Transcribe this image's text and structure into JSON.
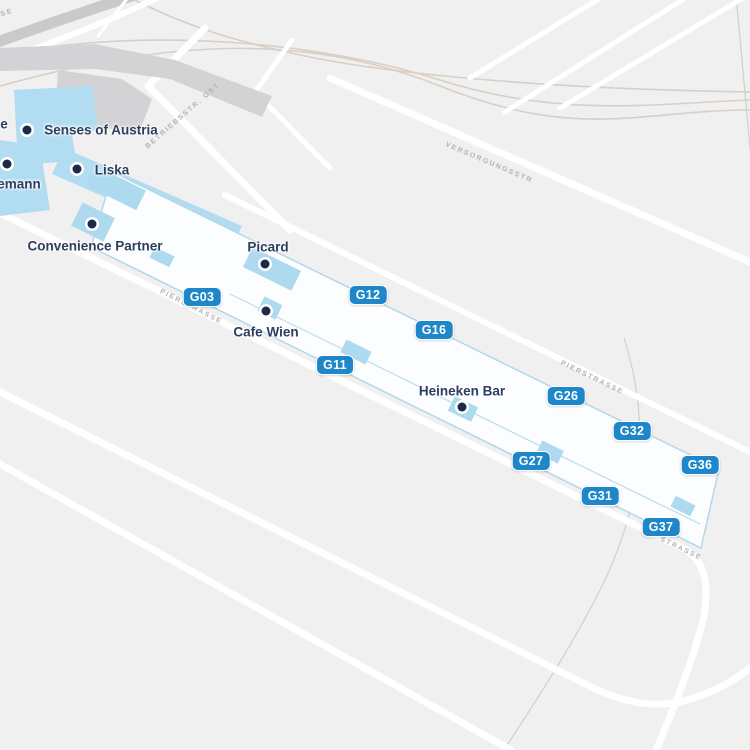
{
  "map": {
    "pois": [
      {
        "label": "Senses of Austria",
        "label_x": 101,
        "label_y": 130,
        "dot_x": 27,
        "dot_y": 130
      },
      {
        "label": "Liska",
        "label_x": 112,
        "label_y": 170,
        "dot_x": 77,
        "dot_y": 169
      },
      {
        "label": "emann",
        "label_x": 19,
        "label_y": 184,
        "dot_x": 7,
        "dot_y": 164
      },
      {
        "label": "Convenience Partner",
        "label_x": 95,
        "label_y": 246,
        "dot_x": 92,
        "dot_y": 224
      },
      {
        "label": "Picard",
        "label_x": 268,
        "label_y": 247,
        "dot_x": 265,
        "dot_y": 264
      },
      {
        "label": "Cafe Wien",
        "label_x": 266,
        "label_y": 332,
        "dot_x": 266,
        "dot_y": 311
      },
      {
        "label": "Heineken Bar",
        "label_x": 462,
        "label_y": 391,
        "dot_x": 462,
        "dot_y": 407
      }
    ],
    "partial_labels": [
      {
        "text": "e",
        "x": 4,
        "y": 124
      }
    ],
    "gates": [
      {
        "label": "G03",
        "x": 202,
        "y": 297
      },
      {
        "label": "G11",
        "x": 335,
        "y": 365
      },
      {
        "label": "G12",
        "x": 368,
        "y": 295
      },
      {
        "label": "G16",
        "x": 434,
        "y": 330
      },
      {
        "label": "G26",
        "x": 566,
        "y": 396
      },
      {
        "label": "G27",
        "x": 531,
        "y": 461
      },
      {
        "label": "G31",
        "x": 600,
        "y": 496
      },
      {
        "label": "G32",
        "x": 632,
        "y": 431
      },
      {
        "label": "G36",
        "x": 700,
        "y": 465
      },
      {
        "label": "G37",
        "x": 661,
        "y": 527
      }
    ],
    "streets": [
      {
        "text": "SE",
        "x": 7,
        "y": 13,
        "rot": -18
      },
      {
        "text": "BETRIEBSSTR. OST",
        "x": 183,
        "y": 116,
        "rot": -41
      },
      {
        "text": "VERSORGUNGSSTR",
        "x": 489,
        "y": 163,
        "rot": 23
      },
      {
        "text": "PIERSTRASSE",
        "x": 191,
        "y": 307,
        "rot": 27
      },
      {
        "text": "PIERSTRASSE",
        "x": 592,
        "y": 378,
        "rot": 26
      },
      {
        "text": "STRASSE",
        "x": 681,
        "y": 549,
        "rot": 26
      }
    ],
    "colors": {
      "background": "#f0f0f1",
      "road": "#ffffff",
      "building_gray": "#d3d3d5",
      "rail_tan": "#d9cfc4",
      "pier_fill": "#fcfdfe",
      "pier_border": "#b3d7ea",
      "area_blue": "#b2dcf1",
      "gate_badge_blue": "#1e87c9",
      "poi_dot_navy": "#1b2a47",
      "poi_text": "#2e3e5f",
      "street_text": "#b5b2ae"
    }
  }
}
